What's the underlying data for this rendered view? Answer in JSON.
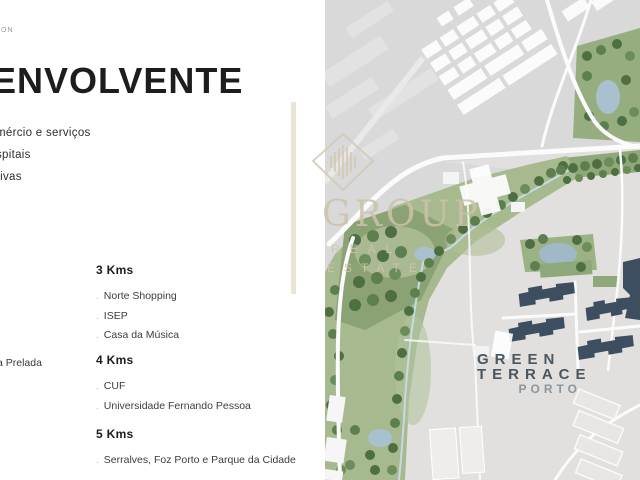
{
  "slide": {
    "kicker": "ON",
    "title": "ENVOLVENTE",
    "intro_items": [
      "mércio e serviços",
      "spitais",
      "rivas"
    ],
    "left_edge_item": "a Prelada",
    "item_bullet": ".",
    "distance_groups": [
      {
        "heading": "3 Kms",
        "items": [
          "Norte Shopping",
          "ISEP",
          "Casa da Música"
        ]
      },
      {
        "heading": "4 Kms",
        "items": [
          "CUF",
          "Universidade Fernando Pessoa"
        ]
      },
      {
        "heading": "5 Kms",
        "items": [
          "Serralves, Foz Porto e Parque da Cidade"
        ]
      }
    ]
  },
  "watermark": {
    "brand": "GROUP",
    "subtitle_line1": "REAL",
    "subtitle_line2": "ESTATE"
  },
  "map": {
    "project_line1": "GREEN",
    "project_line2": "TERRACE",
    "project_line3": "PORTO"
  },
  "colors": {
    "accent_beige": "#ece4d2",
    "watermark_beige": "#cfc4ae",
    "map_base_gray": "#d9d9d9",
    "park_green": "#96ad80",
    "pond_blue": "#a9c0ce",
    "building_navy": "#3d4e60",
    "label_slate": "#4a5660"
  }
}
